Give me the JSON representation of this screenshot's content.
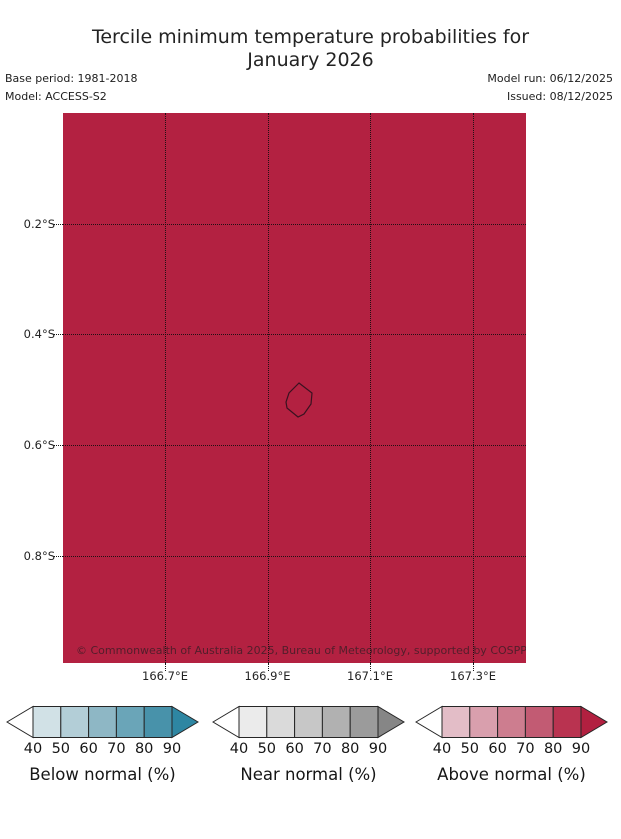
{
  "header": {
    "title_line1": "Tercile minimum temperature probabilities for",
    "title_line2": "January 2026",
    "base_period": "Base period: 1981-2018",
    "model": "Model: ACCESS-S2",
    "model_run": "Model run: 06/12/2025",
    "issued": "Issued: 08/12/2025"
  },
  "map": {
    "fill_color": "#b32141",
    "gridline_color": "#141414",
    "island_outline_color": "#3a1220",
    "island_points": "236,270 249,280 248,291 241,301 235,304 224,295 223,289 226,280",
    "copyright": "© Commonwealth of Australia 2025, Bureau of Meteorology, supported by COSPPac",
    "y_ticks": [
      "0.2°S",
      "0.4°S",
      "0.6°S",
      "0.8°S"
    ],
    "x_ticks": [
      "166.7°E",
      "166.9°E",
      "167.1°E",
      "167.3°E"
    ]
  },
  "colorbars": [
    {
      "label": "Below normal (%)",
      "ticks": [
        "40",
        "50",
        "60",
        "70",
        "80",
        "90"
      ],
      "segment_colors": [
        "#d1e1e6",
        "#b3ced7",
        "#8eb7c5",
        "#6aa5b8",
        "#4892aa"
      ],
      "over_color": "#2e86a2",
      "under_color": "#ffffff"
    },
    {
      "label": "Near normal (%)",
      "ticks": [
        "40",
        "50",
        "60",
        "70",
        "80",
        "90"
      ],
      "segment_colors": [
        "#ebebeb",
        "#dadada",
        "#c7c7c7",
        "#b1b1b1",
        "#9b9b9b"
      ],
      "over_color": "#868686",
      "under_color": "#ffffff"
    },
    {
      "label": "Above normal (%)",
      "ticks": [
        "40",
        "50",
        "60",
        "70",
        "80",
        "90"
      ],
      "segment_colors": [
        "#e3bdc7",
        "#d99fad",
        "#cd7d8f",
        "#c25b73",
        "#b93350"
      ],
      "over_color": "#b22040",
      "under_color": "#ffffff"
    }
  ],
  "chart_data": {
    "type": "heatmap",
    "title": "Tercile minimum temperature probabilities for January 2026",
    "base_period": "1981-2018",
    "model": "ACCESS-S2",
    "model_run": "06/12/2025",
    "issued": "08/12/2025",
    "x_axis": {
      "label": "Longitude",
      "tick_labels": [
        "166.7°E",
        "166.9°E",
        "167.1°E",
        "167.3°E"
      ],
      "range_deg_east": [
        166.5,
        167.4
      ],
      "grid": true
    },
    "y_axis": {
      "label": "Latitude",
      "tick_labels": [
        "0.2°S",
        "0.4°S",
        "0.6°S",
        "0.8°S"
      ],
      "range_deg_south": [
        0.0,
        1.0
      ],
      "grid": true
    },
    "field_values": "Uniform across entire map domain: 'Above normal' tercile probability greater than 90% (rendered as the darkest red / over-arrow color of the Above normal colorbar)",
    "dominant_category": "Above normal",
    "dominant_probability_percent": ">90",
    "annotations": [
      "Outline of Nauru island near 166.93°E, 0.52°S"
    ],
    "legends": [
      {
        "title": "Below normal (%)",
        "bins": [
          40,
          50,
          60,
          70,
          80,
          90
        ],
        "style": "discrete colorbar with under/over arrows, teal ramp"
      },
      {
        "title": "Near normal (%)",
        "bins": [
          40,
          50,
          60,
          70,
          80,
          90
        ],
        "style": "discrete colorbar with under/over arrows, gray ramp"
      },
      {
        "title": "Above normal (%)",
        "bins": [
          40,
          50,
          60,
          70,
          80,
          90
        ],
        "style": "discrete colorbar with under/over arrows, red ramp"
      }
    ],
    "legend_position": "bottom"
  }
}
